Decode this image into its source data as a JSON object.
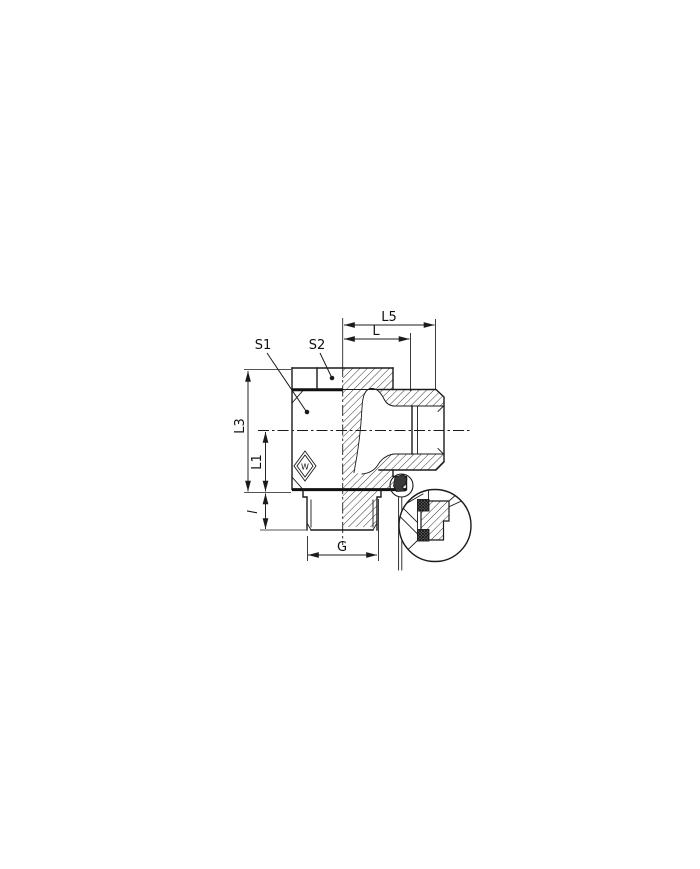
{
  "drawing": {
    "type": "engineering-cross-section",
    "subject": "banjo swivel elbow fitting with seal detail view",
    "background": "#ffffff",
    "line_color": "#1b1b1b",
    "labels": {
      "L5": "L5",
      "L": "L",
      "S1": "S1",
      "S2": "S2",
      "L3": "L3",
      "L1": "L1",
      "l": "l",
      "G": "G",
      "logo": "W"
    }
  }
}
